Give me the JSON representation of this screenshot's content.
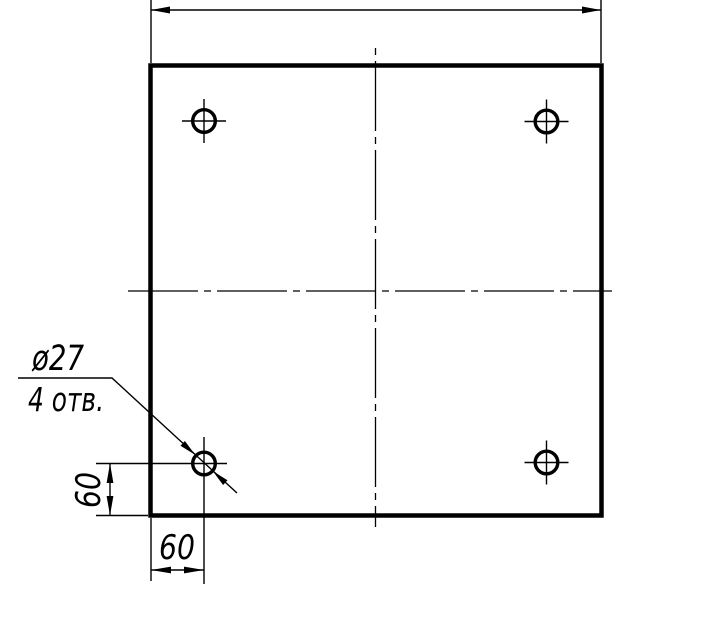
{
  "drawing": {
    "background_color": "#ffffff",
    "ink_color": "#000000",
    "hole_callout": {
      "diameter": "ø27",
      "count": "4 отв."
    },
    "dimensions": {
      "hole_offset_vertical": "60",
      "hole_offset_horizontal": "60"
    }
  }
}
